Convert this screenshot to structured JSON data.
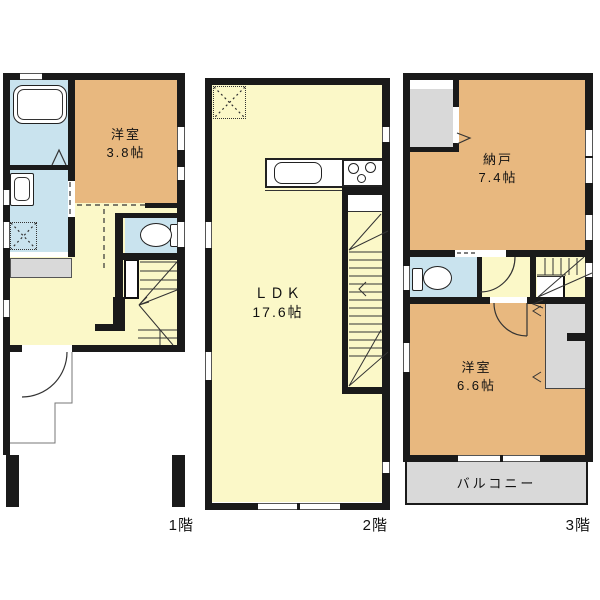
{
  "colors": {
    "wall": "#1a1a1a",
    "line": "#333333",
    "orange": "#e8b87f",
    "yellow": "#fbf8c8",
    "blue": "#c9e3ee",
    "gray": "#d9d9d9",
    "background": "#ffffff"
  },
  "floors": [
    {
      "label": "1階",
      "rooms": [
        {
          "name": "洋室",
          "size": "3.8帖"
        }
      ]
    },
    {
      "label": "2階",
      "rooms": [
        {
          "name": "ＬＤＫ",
          "size": "17.6帖"
        }
      ]
    },
    {
      "label": "3階",
      "rooms": [
        {
          "name": "納戸",
          "size": "7.4帖"
        },
        {
          "name": "洋室",
          "size": "6.6帖"
        }
      ],
      "balcony": "バルコニー"
    }
  ]
}
